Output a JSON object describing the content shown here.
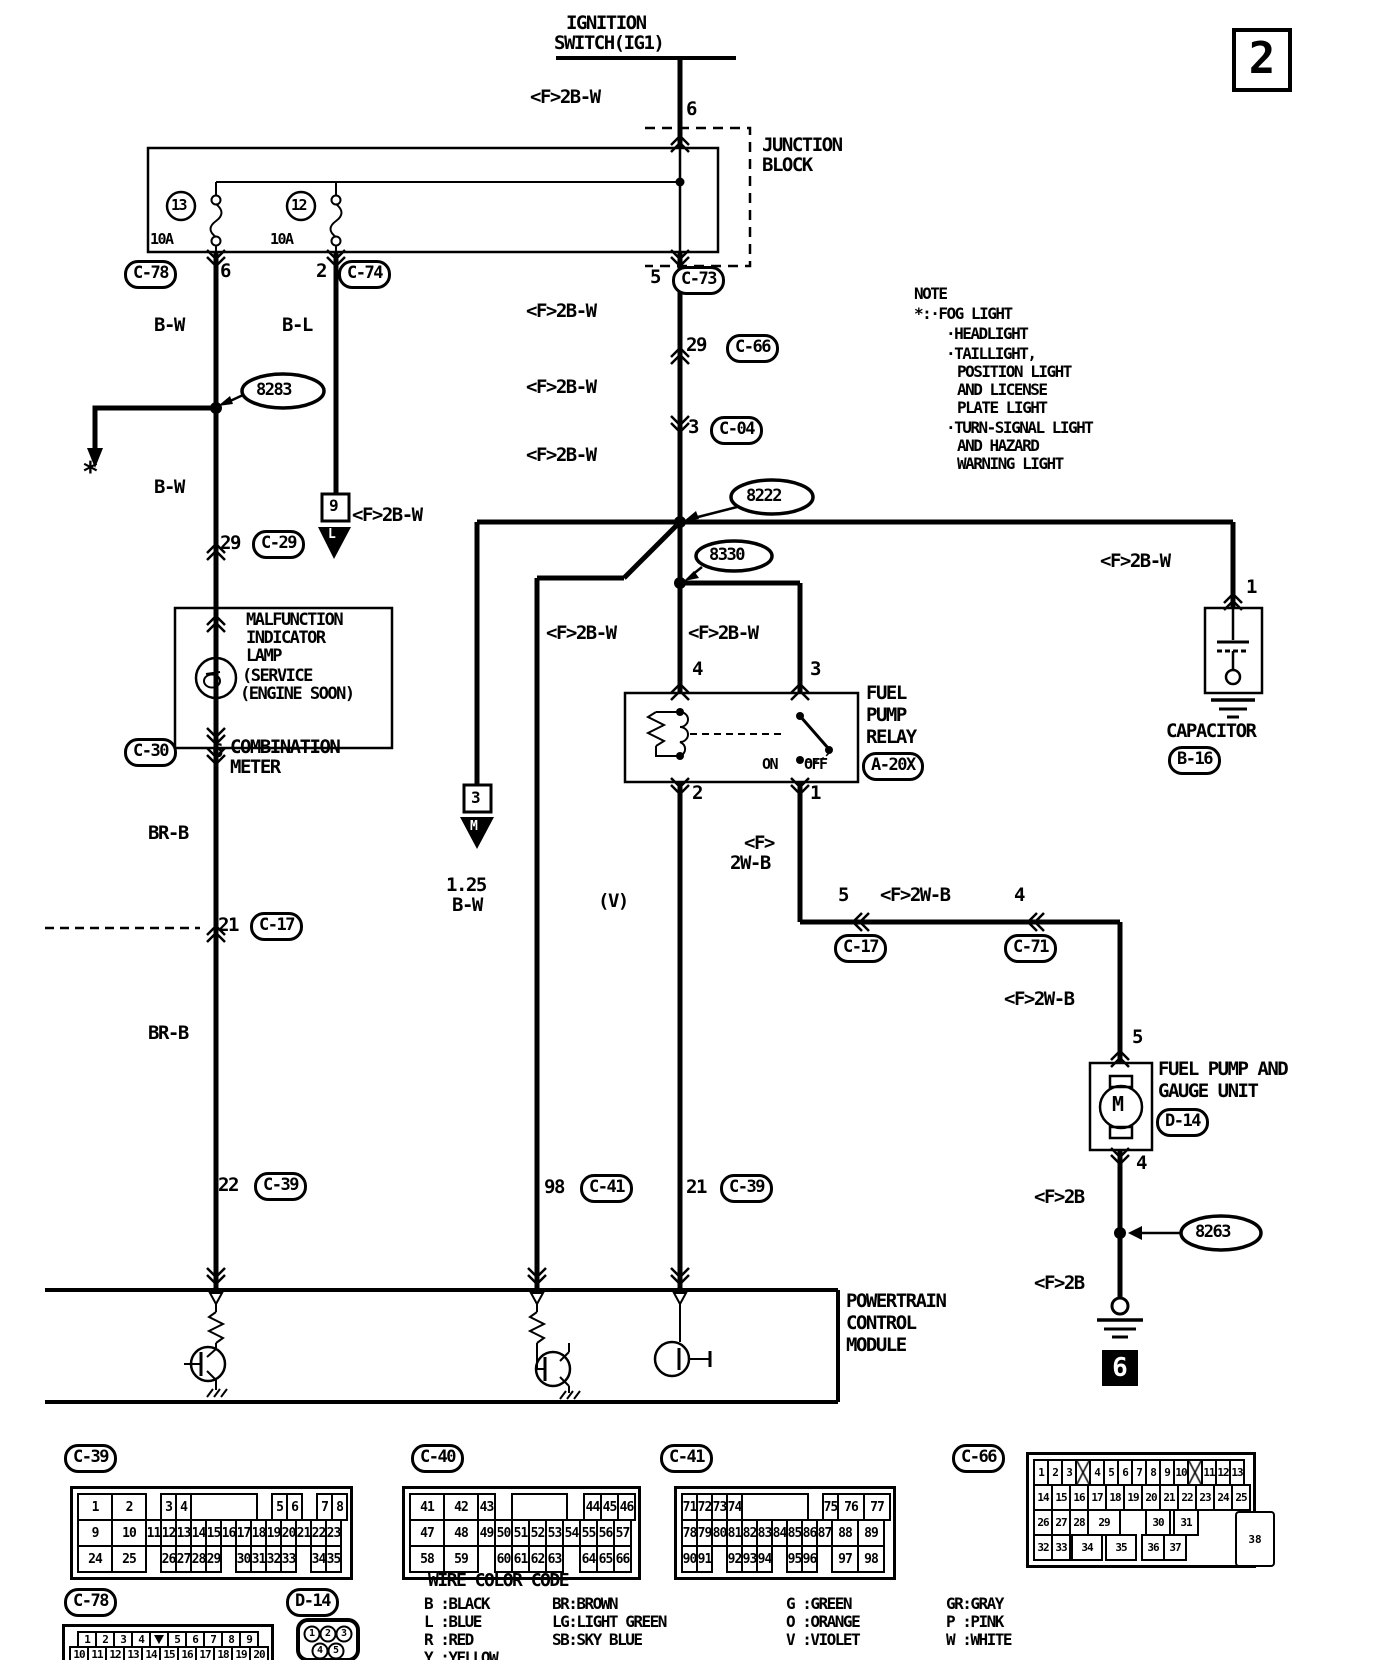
{
  "badges": {
    "page": "2",
    "ground_ref": "6"
  },
  "labels": {
    "ign1": "IGNITION",
    "ign2": "SWITCH(IG1)",
    "f2bw_top": "<F>2B-W",
    "pin6_top": "6",
    "jb1": "JUNCTION",
    "jb2": "BLOCK",
    "f13": "13",
    "f12": "12",
    "a13": "10A",
    "a12": "10A",
    "p6c78": "6",
    "p2c74": "2",
    "p5c73": "5",
    "bw1": "B-W",
    "bl": "B-L",
    "star": "*",
    "bw2": "B-W",
    "p29c29": "29",
    "mil1": "MALFUNCTION",
    "mil2": "INDICATOR",
    "mil3": "LAMP",
    "mil4": "(SERVICE",
    "mil5": "(ENGINE SOON)",
    "p6c30": "6",
    "cm1": "COMBINATION",
    "cm2": "METER",
    "brb1": "BR-B",
    "p21c17": "21",
    "brb2": "BR-B",
    "p22c39": "22",
    "b9": "9",
    "t9": "L",
    "f2bwm1": "<F>2B-W",
    "p29c66": "29",
    "f2bwm2": "<F>2B-W",
    "p3c04": "3",
    "f2bwm3": "<F>2B-W",
    "f2bwL": "<F>2B-W",
    "s8283": "8283",
    "s8222": "8222",
    "s8330": "8330",
    "s8263": "8263",
    "f2bwr4": "<F>2B-W",
    "f2bwr3": "<F>2B-W",
    "p4rel": "4",
    "p3rel": "3",
    "fpr1": "FUEL",
    "fpr2": "PUMP",
    "fpr3": "RELAY",
    "on": "ON",
    "off": "OFF",
    "p2rel": "2",
    "p1rel": "1",
    "b3": "3",
    "t3": "M",
    "fst": "<F>",
    "wbst": "2W-B",
    "vlab": "(V)",
    "b125a": "1.25",
    "b125b": "B-W",
    "p5c17": "5",
    "f2wbh": "<F>2W-B",
    "p4c71": "4",
    "f2bwcap": "<F>2B-W",
    "p1cap": "1",
    "cap1": "CAPACITOR",
    "f2wbv": "<F>2W-B",
    "p5d14": "5",
    "fp1": "FUEL PUMP AND",
    "fp2": "GAUGE UNIT",
    "mot": "M",
    "p4d14": "4",
    "f2b1": "<F>2B",
    "f2b2": "<F>2B",
    "p98c41": "98",
    "p21c39": "21",
    "pcm1": "POWERTRAIN",
    "pcm2": "CONTROL",
    "pcm3": "MODULE",
    "note0": "NOTE",
    "note1": "*:·FOG LIGHT",
    "note2": "·HEADLIGHT",
    "note3": "·TAILLIGHT,",
    "note4": "POSITION LIGHT",
    "note5": "AND LICENSE",
    "note6": "PLATE LIGHT",
    "note7": "·TURN-SIGNAL LIGHT",
    "note8": "AND HAZARD",
    "note9": "WARNING LIGHT",
    "wcct": "WIRE COLOR CODE",
    "wcc_b": "B :BLACK",
    "wcc_br": "BR:BROWN",
    "wcc_g": "G :GREEN",
    "wcc_gr": "GR:GRAY",
    "wcc_l": "L :BLUE",
    "wcc_lg": "LG:LIGHT GREEN",
    "wcc_o": "O :ORANGE",
    "wcc_p": "P :PINK",
    "wcc_r": "R :RED",
    "wcc_sb": "SB:SKY BLUE",
    "wcc_v": "V :VIOLET",
    "wcc_w": "W :WHITE",
    "wcc_y": "Y :YELLOW",
    "d14p1": "1",
    "d14p2": "2",
    "d14p3": "3",
    "d14p4": "4",
    "d14p5": "5"
  },
  "pills": {
    "c78t": "C-78",
    "c74": "C-74",
    "c73": "C-73",
    "c66": "C-66",
    "c04": "C-04",
    "c29": "C-29",
    "c30": "C-30",
    "c17L": "C-17",
    "c39L": "C-39",
    "c41m": "C-41",
    "c39m": "C-39",
    "a20x": "A-20X",
    "c17R": "C-17",
    "c71": "C-71",
    "b16": "B-16",
    "d14": "D-14",
    "btc39": "C-39",
    "btc40": "C-40",
    "btc41": "C-41",
    "btc66": "C-66",
    "btc78": "C-78",
    "btd14": "D-14"
  },
  "pin_tables": {
    "c39": {
      "rows": [
        [
          {
            "t": "1",
            "w": 36
          },
          {
            "t": "2",
            "w": 36
          },
          {
            "g": 17
          },
          {
            "t": "3"
          },
          {
            "t": "4"
          },
          {
            "t": "",
            "w": 68
          },
          {
            "g": 17
          },
          {
            "t": "5"
          },
          {
            "t": "6"
          },
          {
            "g": 17
          },
          {
            "t": "7"
          },
          {
            "t": "8"
          }
        ],
        [
          {
            "t": "9",
            "w": 36
          },
          {
            "t": "10",
            "w": 36
          },
          {
            "t": "11"
          },
          {
            "t": "12"
          },
          {
            "t": "13"
          },
          {
            "t": "14"
          },
          {
            "t": "15"
          },
          {
            "t": "16"
          },
          {
            "t": "17"
          },
          {
            "t": "18"
          },
          {
            "t": "19"
          },
          {
            "t": "20"
          },
          {
            "t": "21"
          },
          {
            "t": "22"
          },
          {
            "t": "23"
          }
        ],
        [
          {
            "t": "24",
            "w": 36
          },
          {
            "t": "25",
            "w": 36
          },
          {
            "g": 17
          },
          {
            "t": "26"
          },
          {
            "t": "27"
          },
          {
            "t": "28"
          },
          {
            "t": "29"
          },
          {
            "g": 17
          },
          {
            "t": "30"
          },
          {
            "t": "31"
          },
          {
            "t": "32"
          },
          {
            "t": "33"
          },
          {
            "g": 17
          },
          {
            "t": "34"
          },
          {
            "t": "35"
          }
        ]
      ]
    },
    "c40": {
      "rows": [
        [
          {
            "t": "41",
            "w": 36
          },
          {
            "t": "42",
            "w": 36
          },
          {
            "t": "43"
          },
          {
            "g": 19
          },
          {
            "t": "",
            "w": 57
          },
          {
            "g": 19
          },
          {
            "t": "44"
          },
          {
            "t": "45"
          },
          {
            "t": "46"
          }
        ],
        [
          {
            "t": "47",
            "w": 36
          },
          {
            "t": "48",
            "w": 36
          },
          {
            "t": "49"
          },
          {
            "t": "50"
          },
          {
            "t": "51"
          },
          {
            "t": "52"
          },
          {
            "t": "53"
          },
          {
            "t": "54"
          },
          {
            "t": "55"
          },
          {
            "t": "56"
          },
          {
            "t": "57"
          }
        ],
        [
          {
            "t": "58",
            "w": 36
          },
          {
            "t": "59",
            "w": 36
          },
          {
            "g": 19
          },
          {
            "t": "60"
          },
          {
            "t": "61"
          },
          {
            "t": "62"
          },
          {
            "t": "63"
          },
          {
            "g": 19
          },
          {
            "t": "64"
          },
          {
            "t": "65"
          },
          {
            "t": "66"
          }
        ]
      ]
    },
    "c41": {
      "rows": [
        [
          {
            "t": "71"
          },
          {
            "t": "72"
          },
          {
            "t": "73"
          },
          {
            "t": "74"
          },
          {
            "t": "",
            "w": 68
          },
          {
            "g": 17
          },
          {
            "t": "75"
          },
          {
            "t": "76",
            "w": 28
          },
          {
            "t": "77",
            "w": 28
          }
        ],
        [
          {
            "t": "78"
          },
          {
            "t": "79"
          },
          {
            "t": "80"
          },
          {
            "t": "81"
          },
          {
            "t": "82"
          },
          {
            "t": "83"
          },
          {
            "t": "84"
          },
          {
            "t": "85"
          },
          {
            "t": "86"
          },
          {
            "t": "87"
          },
          {
            "t": "88",
            "w": 28
          },
          {
            "t": "89",
            "w": 28
          }
        ],
        [
          {
            "t": "90"
          },
          {
            "t": "91"
          },
          {
            "g": 17
          },
          {
            "t": "92"
          },
          {
            "t": "93"
          },
          {
            "t": "94"
          },
          {
            "g": 17
          },
          {
            "t": "95"
          },
          {
            "t": "96"
          },
          {
            "g": 17
          },
          {
            "t": "97",
            "w": 28
          },
          {
            "t": "98",
            "w": 28
          }
        ]
      ]
    },
    "c66": {
      "rows": [
        [
          {
            "t": "1"
          },
          {
            "t": "2"
          },
          {
            "t": "3"
          },
          {
            "x": 1
          },
          {
            "t": "4"
          },
          {
            "t": "5"
          },
          {
            "t": "6"
          },
          {
            "t": "7"
          },
          {
            "t": "8"
          },
          {
            "t": "9"
          },
          {
            "t": "10"
          },
          {
            "x": 1
          },
          {
            "t": "11"
          },
          {
            "t": "12"
          },
          {
            "t": "13"
          }
        ],
        [
          {
            "t": "14",
            "w": 20
          },
          {
            "t": "15",
            "w": 20
          },
          {
            "t": "16",
            "w": 20
          },
          {
            "t": "17",
            "w": 20
          },
          {
            "t": "18",
            "w": 20
          },
          {
            "t": "19",
            "w": 20
          },
          {
            "t": "20",
            "w": 20
          },
          {
            "t": "21",
            "w": 20
          },
          {
            "t": "22",
            "w": 20
          },
          {
            "t": "23",
            "w": 20
          },
          {
            "t": "24",
            "w": 20
          },
          {
            "t": "25",
            "w": 20
          }
        ],
        [
          {
            "t": "26",
            "w": 20
          },
          {
            "t": "27",
            "w": 20
          },
          {
            "t": "28",
            "w": 20
          },
          {
            "t": "29",
            "w": 34
          },
          {
            "g": 28
          },
          {
            "t": "30",
            "w": 26
          },
          {
            "g": 6
          },
          {
            "t": "31",
            "w": 26
          }
        ],
        [
          {
            "t": "32",
            "w": 20
          },
          {
            "t": "33",
            "w": 20
          },
          {
            "g": 4
          },
          {
            "t": "34",
            "w": 32
          },
          {
            "g": 6
          },
          {
            "t": "35",
            "w": 32
          },
          {
            "g": 8
          },
          {
            "t": "36",
            "w": 24
          },
          {
            "t": "37",
            "w": 24
          }
        ]
      ],
      "extra": {
        "t": "38"
      }
    },
    "c78b": {
      "rows": [
        [
          {
            "g": 10
          },
          {
            "t": "1"
          },
          {
            "t": "2"
          },
          {
            "t": "3"
          },
          {
            "t": "4"
          },
          {
            "tri": 1
          },
          {
            "t": "5"
          },
          {
            "t": "6"
          },
          {
            "t": "7"
          },
          {
            "t": "8"
          },
          {
            "t": "9"
          }
        ],
        [
          {
            "t": "10"
          },
          {
            "t": "11"
          },
          {
            "t": "12"
          },
          {
            "t": "13"
          },
          {
            "t": "14"
          },
          {
            "t": "15"
          },
          {
            "t": "16"
          },
          {
            "t": "17"
          },
          {
            "t": "18"
          },
          {
            "t": "19"
          },
          {
            "t": "20"
          }
        ]
      ]
    }
  }
}
